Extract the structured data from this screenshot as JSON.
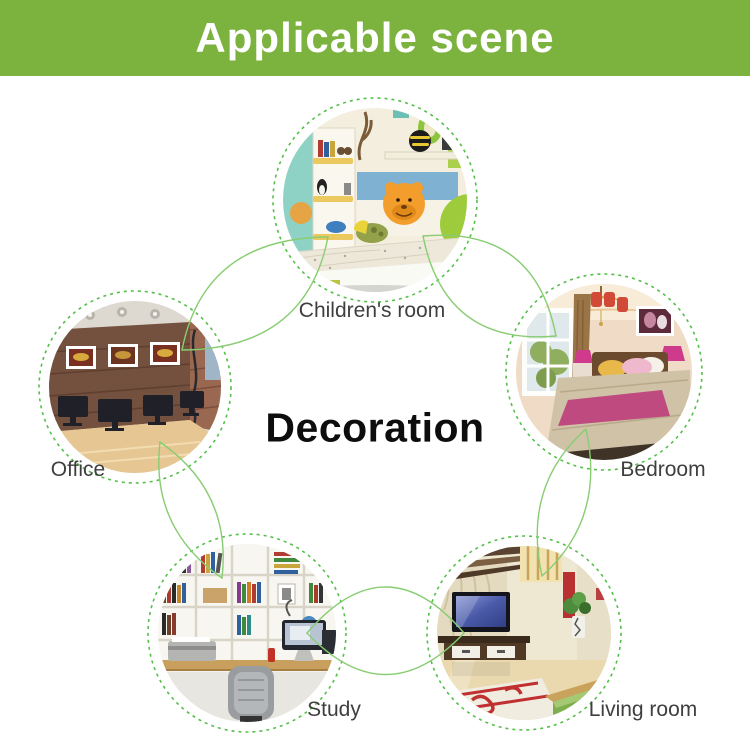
{
  "header": {
    "title": "Applicable scene",
    "bg_color": "#7bb33e",
    "text_color": "#ffffff"
  },
  "center": {
    "label": "Decoration",
    "color": "#0d0d0d"
  },
  "rooms": [
    {
      "id": "children-room",
      "label": "Children's room",
      "position": "top"
    },
    {
      "id": "bedroom",
      "label": "Bedroom",
      "position": "right-upper"
    },
    {
      "id": "living-room",
      "label": "Living room",
      "position": "right-lower"
    },
    {
      "id": "study",
      "label": "Study",
      "position": "left-lower"
    },
    {
      "id": "office",
      "label": "Office",
      "position": "left-upper"
    }
  ],
  "diagram": {
    "connector_color": "#88cd72",
    "dashed_circle_color": "#55bf4a",
    "label_color": "#3f3f3f"
  }
}
